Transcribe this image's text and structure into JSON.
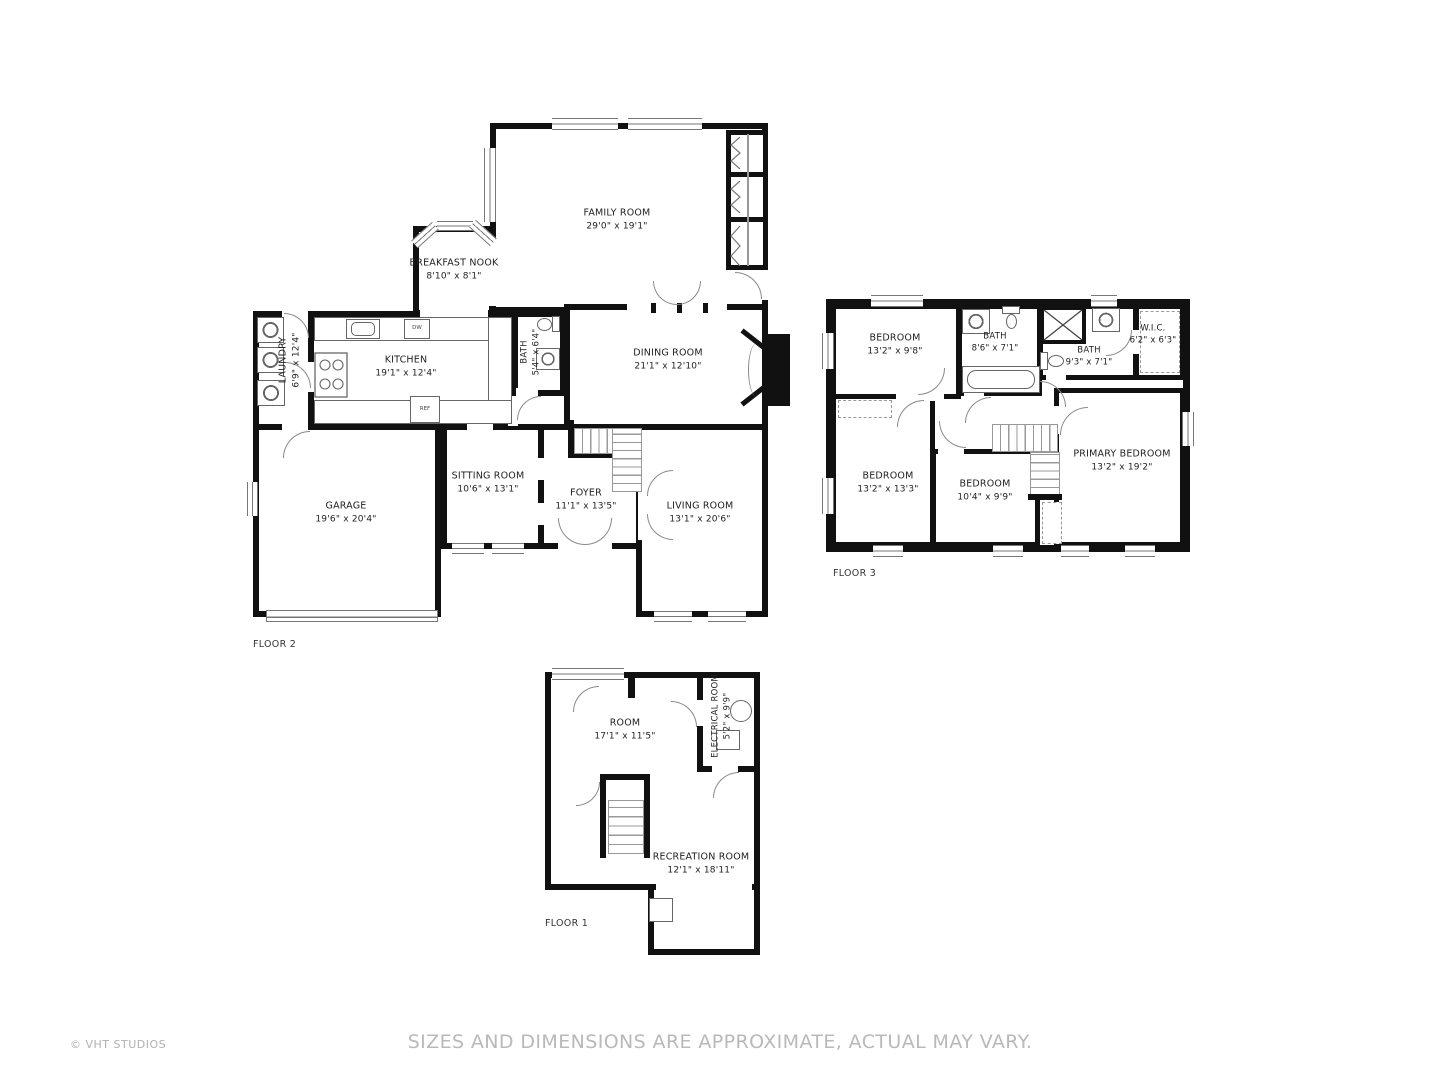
{
  "meta": {
    "copyright": "© VHT STUDIOS",
    "disclaimer": "SIZES AND DIMENSIONS ARE APPROXIMATE, ACTUAL MAY VARY."
  },
  "floors": {
    "floor2": {
      "label": "FLOOR 2",
      "rooms": {
        "family": {
          "name": "FAMILY ROOM",
          "dims": "29'0\" x 19'1\""
        },
        "breakfast": {
          "name": "BREAKFAST NOOK",
          "dims": "8'10\" x 8'1\""
        },
        "kitchen": {
          "name": "KITCHEN",
          "dims": "19'1\" x 12'4\""
        },
        "laundry": {
          "name": "LAUNDRY",
          "dims": "6'9\" x 12'4\""
        },
        "bath": {
          "name": "BATH",
          "dims": "5'4\" x 6'4\""
        },
        "dining": {
          "name": "DINING ROOM",
          "dims": "21'1\" x 12'10\""
        },
        "garage": {
          "name": "GARAGE",
          "dims": "19'6\" x 20'4\""
        },
        "sitting": {
          "name": "SITTING ROOM",
          "dims": "10'6\" x 13'1\""
        },
        "foyer": {
          "name": "FOYER",
          "dims": "11'1\" x 13'5\""
        },
        "living": {
          "name": "LIVING ROOM",
          "dims": "13'1\" x 20'6\""
        }
      },
      "fixtures": {
        "ref": "REF",
        "dw": "DW"
      }
    },
    "floor3": {
      "label": "FLOOR 3",
      "rooms": {
        "bedroom1": {
          "name": "BEDROOM",
          "dims": "13'2\" x 9'8\""
        },
        "bath1": {
          "name": "BATH",
          "dims": "8'6\" x 7'1\""
        },
        "bath2": {
          "name": "BATH",
          "dims": "9'3\" x 7'1\""
        },
        "wic": {
          "name": "W.I.C.",
          "dims": "6'2\" x 6'3\""
        },
        "bedroom2": {
          "name": "BEDROOM",
          "dims": "13'2\" x 13'3\""
        },
        "bedroom3": {
          "name": "BEDROOM",
          "dims": "10'4\" x 9'9\""
        },
        "primary": {
          "name": "PRIMARY BEDROOM",
          "dims": "13'2\" x 19'2\""
        }
      }
    },
    "floor1": {
      "label": "FLOOR 1",
      "rooms": {
        "room": {
          "name": "ROOM",
          "dims": "17'1\" x 11'5\""
        },
        "electrical": {
          "name": "ELECTRICAL ROOM",
          "dims": "5'2\" x 9'9\""
        },
        "recreation": {
          "name": "RECREATION ROOM",
          "dims": "12'1\" x 18'11\""
        }
      }
    }
  }
}
